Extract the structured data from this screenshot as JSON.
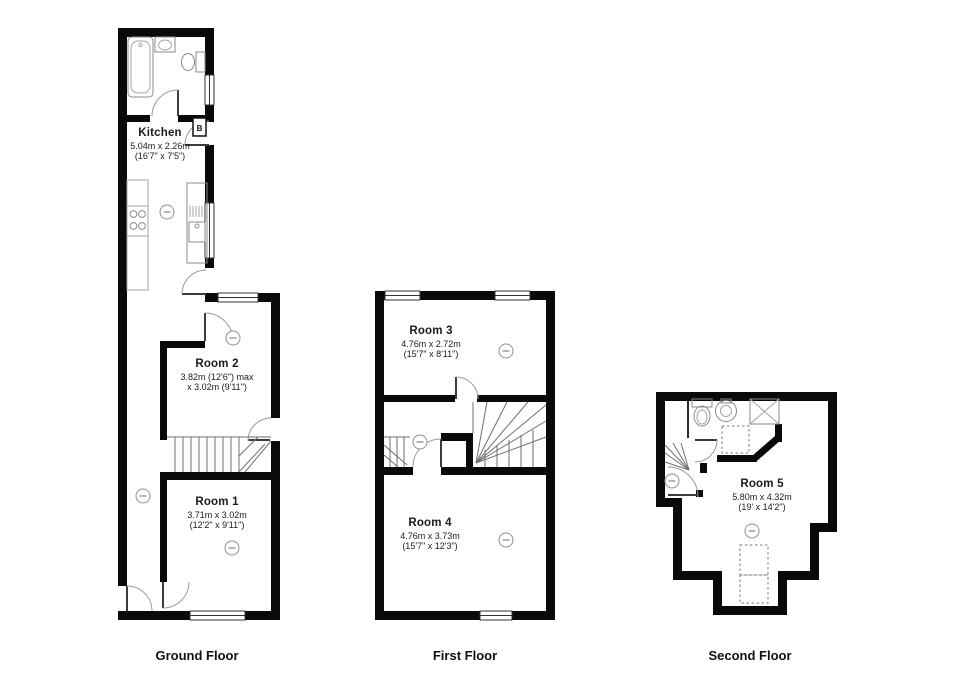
{
  "colors": {
    "wall": "#0a0a0a",
    "fixture": "#8a8a8a",
    "text": "#1b1b1b",
    "background": "#ffffff"
  },
  "floors": [
    {
      "label": "Ground Floor",
      "boiler_label": "B",
      "rooms": [
        {
          "name": "Kitchen",
          "dims": [
            "5.04m x 2.26m",
            "(16'7\" x 7'5\")"
          ]
        },
        {
          "name": "Room 2",
          "dims": [
            "3.82m (12'6\") max",
            "x 3.02m (9'11\")"
          ]
        },
        {
          "name": "Room 1",
          "dims": [
            "3.71m x 3.02m",
            "(12'2\" x 9'11\")"
          ]
        }
      ]
    },
    {
      "label": "First Floor",
      "rooms": [
        {
          "name": "Room 3",
          "dims": [
            "4.76m x 2.72m",
            "(15'7\" x 8'11\")"
          ]
        },
        {
          "name": "Room 4",
          "dims": [
            "4.76m x 3.73m",
            "(15'7\" x 12'3\")"
          ]
        }
      ]
    },
    {
      "label": "Second Floor",
      "rooms": [
        {
          "name": "Room 5",
          "dims": [
            "5.80m x 4.32m",
            "(19' x 14'2\")"
          ]
        }
      ]
    }
  ]
}
